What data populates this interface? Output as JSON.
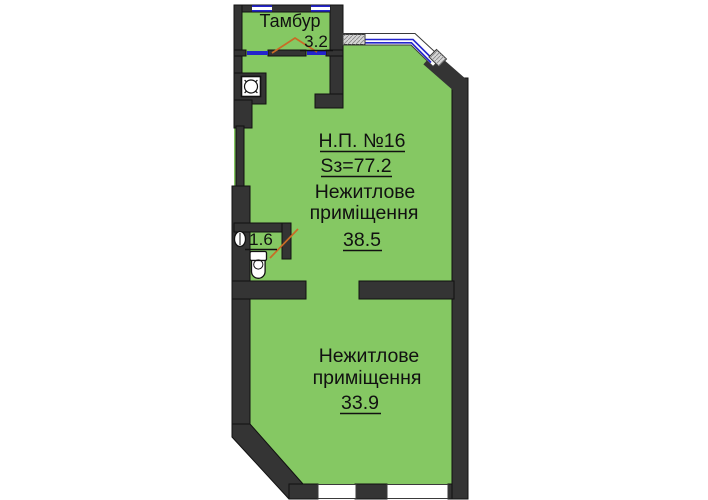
{
  "labels": {
    "tambour": {
      "name": "Тамбур",
      "area": "3.2"
    },
    "unit": {
      "number": "Н.П. №16",
      "total_area": "Sз=77.2"
    },
    "room_upper": {
      "line1": "Нежитлове",
      "line2": "приміщення",
      "area": "38.5"
    },
    "wc": {
      "area": "1.6"
    },
    "room_lower": {
      "line1": "Нежитлове",
      "line2": "приміщення",
      "area": "33.9"
    }
  },
  "colors": {
    "background": "#ffffff",
    "room_fill": "#85c863",
    "wall": "#343434",
    "window_line": "#2424cc",
    "door_swing": "#c96b25",
    "hatch_fill": "#d6d6d6",
    "text": "#111111"
  }
}
